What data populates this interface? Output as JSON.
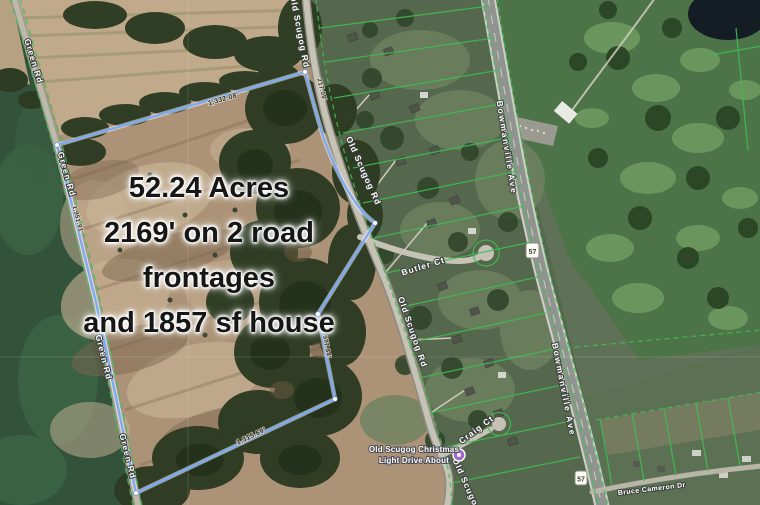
{
  "map": {
    "annotation_lines": [
      "52.24 Acres",
      "2169' on 2 road",
      "frontages",
      "and 1857 sf house"
    ],
    "roads": {
      "green_rd": "Green Rd",
      "old_scugog_rd": "Old Scugog Rd",
      "old_scugog_partial": "Old Scugog",
      "bowmanville_ave": "Bowmanville Ave",
      "butler_ct": "Butler Ct",
      "craig_ct": "Craig Ct",
      "bruce_cameron_dr": "Bruce Cameron Dr",
      "highway_shield": "57"
    },
    "boundary_measurements": {
      "north": "1,332.08'",
      "old_scugog_frontage": "217.09'",
      "east": "977.84'",
      "south": "1,315.69'",
      "green_rd_frontage": "1,951.91'"
    },
    "poi": {
      "label_line1": "Old Scugog Christmas",
      "label_line2": "Light Drive About"
    },
    "colors": {
      "boundary_blue": "#7faaf2",
      "parcel_green": "#3fbd55",
      "poi_purple": "#a168c9",
      "annotation_text": "#161616"
    }
  }
}
